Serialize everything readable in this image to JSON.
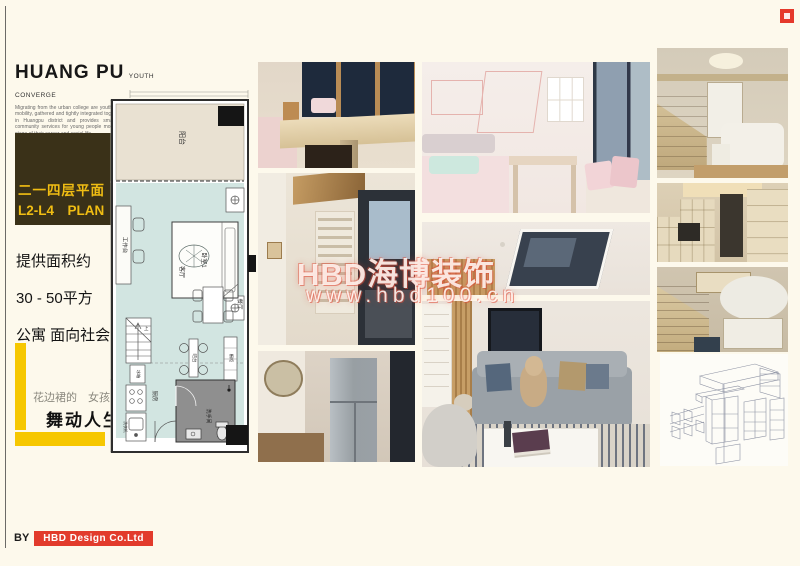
{
  "brand": {
    "title": "HUANG PU",
    "subtitle": "YOUTH CONVERGE",
    "intro": "Migrating from the urban college are youth in a period of transition and mobility, gathered and tightly integrated together. Youth station is located in Huangpu district and provides small shared apartments and community services for young people moving into the city for the first stage of their career and social life."
  },
  "badge": {
    "line1": "二一四层平面",
    "line2": "L2-L4　PLAN"
  },
  "summary": {
    "line1": "提供面积约",
    "line2": "30 - 50平方",
    "line3": "公寓 面向社会"
  },
  "slogan": {
    "small": "花边裙的　女孩",
    "big": "舞动人生"
  },
  "floorplan": {
    "balcony": "阳台",
    "desk": "工作台",
    "bedroom": "卧室1",
    "living": "客厅",
    "dining": "餐厅",
    "bar": "吧台",
    "cabinet": "橱柜",
    "stairs_up": "上",
    "fridge": "冰箱",
    "washer": "洗衣机",
    "kitchen": "厨房",
    "bath": "洗手间"
  },
  "watermark": {
    "line1": "HBD海博装饰",
    "line2": "www.hbd100.cn"
  },
  "footer": {
    "by": "BY",
    "company": "HBD Design Co.Ltd"
  },
  "colors": {
    "accent_yellow": "#f6c700",
    "accent_red": "#e23b2c",
    "badge_bg": "#3a3118",
    "badge_text": "#f0bd13",
    "plan_floor": "#d2e5e1",
    "plan_balcony": "#e9e1d2"
  }
}
